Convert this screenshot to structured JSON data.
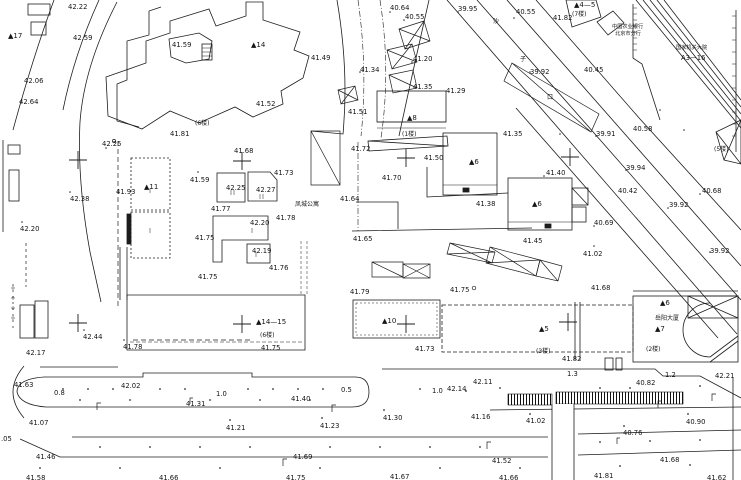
{
  "map": {
    "type": "topographic-site-plan",
    "colors": {
      "background": "#ffffff",
      "line": "#1d1d1d",
      "label": "#151515"
    },
    "grid_crosses": [
      [
        78,
        160
      ],
      [
        242,
        161
      ],
      [
        406,
        158
      ],
      [
        570,
        157
      ],
      [
        78,
        323
      ],
      [
        242,
        324
      ],
      [
        406,
        324
      ],
      [
        568,
        322
      ]
    ],
    "labels": [
      {
        "t": "42.22",
        "x": 68,
        "y": 3,
        "c": "elev"
      },
      {
        "t": "42.59",
        "x": 73,
        "y": 34,
        "c": "elev"
      },
      {
        "t": "▲17",
        "x": 8,
        "y": 32,
        "c": "bld"
      },
      {
        "t": "41.59",
        "x": 172,
        "y": 41,
        "c": "elev"
      },
      {
        "t": "42.06",
        "x": 24,
        "y": 77,
        "c": "elev"
      },
      {
        "t": "42.64",
        "x": 19,
        "y": 98,
        "c": "elev"
      },
      {
        "t": "▲14",
        "x": 251,
        "y": 41,
        "c": "bld"
      },
      {
        "t": "41.49",
        "x": 311,
        "y": 54,
        "c": "elev"
      },
      {
        "t": "41.52",
        "x": 256,
        "y": 100,
        "c": "elev"
      },
      {
        "t": "41.51",
        "x": 348,
        "y": 108,
        "c": "elev"
      },
      {
        "t": "40.64",
        "x": 390,
        "y": 4,
        "c": "elev"
      },
      {
        "t": "40.55",
        "x": 405,
        "y": 13,
        "c": "elev"
      },
      {
        "t": "39.95",
        "x": 458,
        "y": 5,
        "c": "elev"
      },
      {
        "t": "41.34",
        "x": 360,
        "y": 66,
        "c": "elev"
      },
      {
        "t": "41.20",
        "x": 413,
        "y": 55,
        "c": "elev"
      },
      {
        "t": "41.35",
        "x": 413,
        "y": 83,
        "c": "elev"
      },
      {
        "t": "41.29",
        "x": 446,
        "y": 87,
        "c": "elev"
      },
      {
        "t": "▲8",
        "x": 407,
        "y": 114,
        "c": "bld"
      },
      {
        "t": "(1楼)",
        "x": 402,
        "y": 130,
        "c": "cjk"
      },
      {
        "t": "40.55",
        "x": 516,
        "y": 8,
        "c": "elev"
      },
      {
        "t": "41.82",
        "x": 553,
        "y": 14,
        "c": "elev"
      },
      {
        "t": "▲4—5",
        "x": 574,
        "y": 1,
        "c": "bld"
      },
      {
        "t": "(7楼)",
        "x": 572,
        "y": 10,
        "c": "cjk"
      },
      {
        "t": "中国农业银行",
        "x": 612,
        "y": 22,
        "c": "cjks"
      },
      {
        "t": "北京市分行",
        "x": 615,
        "y": 29,
        "c": "cjks"
      },
      {
        "t": "国家机关大院",
        "x": 676,
        "y": 43,
        "c": "cjks"
      },
      {
        "t": "A3—16",
        "x": 681,
        "y": 54,
        "c": "elev"
      },
      {
        "t": "沙",
        "x": 493,
        "y": 17,
        "c": "cjk"
      },
      {
        "t": "子",
        "x": 520,
        "y": 55,
        "c": "cjk"
      },
      {
        "t": "口",
        "x": 547,
        "y": 93,
        "c": "cjk"
      },
      {
        "t": "39.92",
        "x": 530,
        "y": 68,
        "c": "elev"
      },
      {
        "t": "40.45",
        "x": 584,
        "y": 66,
        "c": "elev"
      },
      {
        "t": "42.25",
        "x": 102,
        "y": 140,
        "c": "elev"
      },
      {
        "t": "41.81",
        "x": 170,
        "y": 130,
        "c": "elev"
      },
      {
        "t": "(6楼)",
        "x": 195,
        "y": 119,
        "c": "cjk"
      },
      {
        "t": "41.68",
        "x": 234,
        "y": 147,
        "c": "elev"
      },
      {
        "t": "41.73",
        "x": 274,
        "y": 169,
        "c": "elev"
      },
      {
        "t": "41.59",
        "x": 190,
        "y": 176,
        "c": "elev"
      },
      {
        "t": "42.25",
        "x": 226,
        "y": 184,
        "c": "elev"
      },
      {
        "t": "42.27",
        "x": 256,
        "y": 186,
        "c": "elev"
      },
      {
        "t": "41.93",
        "x": 116,
        "y": 188,
        "c": "elev"
      },
      {
        "t": "▲11",
        "x": 144,
        "y": 183,
        "c": "bld"
      },
      {
        "t": "42.38",
        "x": 70,
        "y": 195,
        "c": "elev"
      },
      {
        "t": "41.77",
        "x": 211,
        "y": 205,
        "c": "elev"
      },
      {
        "t": "42.20",
        "x": 250,
        "y": 219,
        "c": "elev"
      },
      {
        "t": "41.78",
        "x": 276,
        "y": 214,
        "c": "elev"
      },
      {
        "t": "42.20",
        "x": 20,
        "y": 225,
        "c": "elev"
      },
      {
        "t": "41.75",
        "x": 195,
        "y": 234,
        "c": "elev"
      },
      {
        "t": "42.19",
        "x": 252,
        "y": 247,
        "c": "elev"
      },
      {
        "t": "41.76",
        "x": 269,
        "y": 264,
        "c": "elev"
      },
      {
        "t": "41.75",
        "x": 198,
        "y": 273,
        "c": "elev"
      },
      {
        "t": "凤城公寓",
        "x": 295,
        "y": 200,
        "c": "cjk"
      },
      {
        "t": "41.64",
        "x": 340,
        "y": 195,
        "c": "elev"
      },
      {
        "t": "41.72",
        "x": 351,
        "y": 145,
        "c": "elev"
      },
      {
        "t": "41.50",
        "x": 424,
        "y": 154,
        "c": "elev"
      },
      {
        "t": "41.70",
        "x": 382,
        "y": 174,
        "c": "elev"
      },
      {
        "t": "▲6",
        "x": 469,
        "y": 158,
        "c": "bld"
      },
      {
        "t": "41.38",
        "x": 476,
        "y": 200,
        "c": "elev"
      },
      {
        "t": "▲6",
        "x": 532,
        "y": 200,
        "c": "bld"
      },
      {
        "t": "41.65",
        "x": 353,
        "y": 235,
        "c": "elev"
      },
      {
        "t": "41.35",
        "x": 503,
        "y": 130,
        "c": "elev"
      },
      {
        "t": "41.40",
        "x": 546,
        "y": 169,
        "c": "elev"
      },
      {
        "t": "39.91",
        "x": 596,
        "y": 130,
        "c": "elev"
      },
      {
        "t": "40.58",
        "x": 633,
        "y": 125,
        "c": "elev"
      },
      {
        "t": "39.94",
        "x": 626,
        "y": 164,
        "c": "elev"
      },
      {
        "t": "40.42",
        "x": 618,
        "y": 187,
        "c": "elev"
      },
      {
        "t": "40.68",
        "x": 702,
        "y": 187,
        "c": "elev"
      },
      {
        "t": "39.92",
        "x": 669,
        "y": 201,
        "c": "elev"
      },
      {
        "t": "(5楼)",
        "x": 714,
        "y": 145,
        "c": "cjk"
      },
      {
        "t": "40.69",
        "x": 594,
        "y": 219,
        "c": "elev"
      },
      {
        "t": "41.45",
        "x": 523,
        "y": 237,
        "c": "elev"
      },
      {
        "t": "39.92",
        "x": 710,
        "y": 247,
        "c": "elev"
      },
      {
        "t": "41.02",
        "x": 583,
        "y": 250,
        "c": "elev"
      },
      {
        "t": "41.68",
        "x": 591,
        "y": 284,
        "c": "elev"
      },
      {
        "t": "41.79",
        "x": 350,
        "y": 288,
        "c": "elev"
      },
      {
        "t": "41.75",
        "x": 450,
        "y": 286,
        "c": "elev"
      },
      {
        "t": "▲14—15",
        "x": 256,
        "y": 318,
        "c": "bld"
      },
      {
        "t": "(6楼)",
        "x": 260,
        "y": 331,
        "c": "cjk"
      },
      {
        "t": "41.75",
        "x": 261,
        "y": 344,
        "c": "elev"
      },
      {
        "t": "▲10",
        "x": 382,
        "y": 317,
        "c": "bld"
      },
      {
        "t": "41.73",
        "x": 415,
        "y": 345,
        "c": "elev"
      },
      {
        "t": "▲5",
        "x": 539,
        "y": 325,
        "c": "bld"
      },
      {
        "t": "(3楼)",
        "x": 536,
        "y": 347,
        "c": "cjk"
      },
      {
        "t": "41.82",
        "x": 562,
        "y": 355,
        "c": "elev"
      },
      {
        "t": "▲6",
        "x": 660,
        "y": 299,
        "c": "bld"
      },
      {
        "t": "岳阳大厦",
        "x": 655,
        "y": 314,
        "c": "cjk"
      },
      {
        "t": "▲7",
        "x": 655,
        "y": 325,
        "c": "bld"
      },
      {
        "t": "(2楼)",
        "x": 646,
        "y": 345,
        "c": "cjk"
      },
      {
        "t": "42.44",
        "x": 83,
        "y": 333,
        "c": "elev"
      },
      {
        "t": "42.17",
        "x": 26,
        "y": 349,
        "c": "elev"
      },
      {
        "t": "41.78",
        "x": 123,
        "y": 343,
        "c": "elev"
      },
      {
        "t": "41.63",
        "x": 14,
        "y": 381,
        "c": "elev"
      },
      {
        "t": "0.8",
        "x": 54,
        "y": 389,
        "c": "dim"
      },
      {
        "t": "42.02",
        "x": 121,
        "y": 382,
        "c": "elev"
      },
      {
        "t": "1.0",
        "x": 216,
        "y": 390,
        "c": "dim"
      },
      {
        "t": "41.31",
        "x": 186,
        "y": 400,
        "c": "elev"
      },
      {
        "t": "41.07",
        "x": 29,
        "y": 419,
        "c": "elev"
      },
      {
        "t": "41.21",
        "x": 226,
        "y": 424,
        "c": "elev"
      },
      {
        "t": ".05",
        "x": 1,
        "y": 435,
        "c": "elev"
      },
      {
        "t": "41.46",
        "x": 36,
        "y": 453,
        "c": "elev"
      },
      {
        "t": "41.58",
        "x": 26,
        "y": 474,
        "c": "elev"
      },
      {
        "t": "41.66",
        "x": 159,
        "y": 474,
        "c": "elev"
      },
      {
        "t": "0.5",
        "x": 341,
        "y": 386,
        "c": "dim"
      },
      {
        "t": "41.40",
        "x": 291,
        "y": 395,
        "c": "elev"
      },
      {
        "t": "1.0",
        "x": 432,
        "y": 387,
        "c": "dim"
      },
      {
        "t": "42.14",
        "x": 447,
        "y": 385,
        "c": "elev"
      },
      {
        "t": "42.11",
        "x": 473,
        "y": 378,
        "c": "elev"
      },
      {
        "t": "41.30",
        "x": 383,
        "y": 414,
        "c": "elev"
      },
      {
        "t": "41.16",
        "x": 471,
        "y": 413,
        "c": "elev"
      },
      {
        "t": "41.23",
        "x": 320,
        "y": 422,
        "c": "elev"
      },
      {
        "t": "41.69",
        "x": 293,
        "y": 453,
        "c": "elev"
      },
      {
        "t": "41.52",
        "x": 492,
        "y": 457,
        "c": "elev"
      },
      {
        "t": "41.75",
        "x": 286,
        "y": 474,
        "c": "elev"
      },
      {
        "t": "41.67",
        "x": 390,
        "y": 473,
        "c": "elev"
      },
      {
        "t": "1.3",
        "x": 567,
        "y": 370,
        "c": "dim"
      },
      {
        "t": "1.2",
        "x": 665,
        "y": 371,
        "c": "dim"
      },
      {
        "t": "42.21",
        "x": 715,
        "y": 372,
        "c": "elev"
      },
      {
        "t": "40.82",
        "x": 636,
        "y": 379,
        "c": "elev"
      },
      {
        "t": "41.02",
        "x": 526,
        "y": 417,
        "c": "elev"
      },
      {
        "t": "40.90",
        "x": 686,
        "y": 418,
        "c": "elev"
      },
      {
        "t": "40.76",
        "x": 623,
        "y": 429,
        "c": "elev"
      },
      {
        "t": "41.66",
        "x": 499,
        "y": 474,
        "c": "elev"
      },
      {
        "t": "41.68",
        "x": 660,
        "y": 456,
        "c": "elev"
      },
      {
        "t": "41.81",
        "x": 594,
        "y": 472,
        "c": "elev"
      },
      {
        "t": "41.62",
        "x": 707,
        "y": 474,
        "c": "elev"
      }
    ]
  }
}
